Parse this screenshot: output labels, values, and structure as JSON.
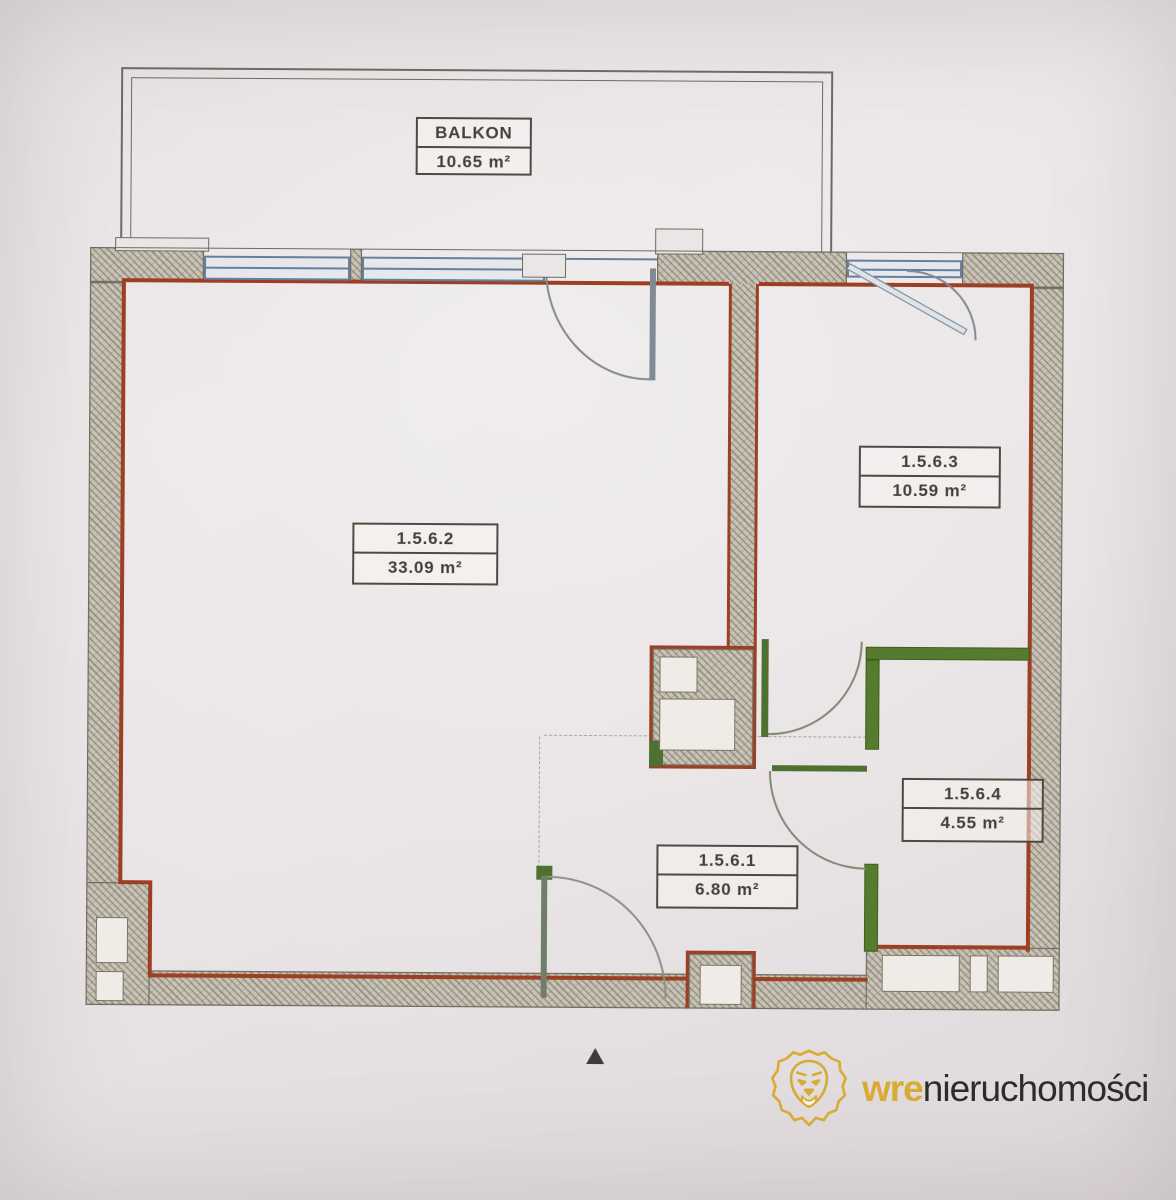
{
  "plan_title": "apartment-floor-plan",
  "balcony": {
    "name": "BALKON",
    "area": "10.65 m²"
  },
  "rooms": [
    {
      "id": "1.5.6.1",
      "area": "6.80 m²"
    },
    {
      "id": "1.5.6.2",
      "area": "33.09 m²"
    },
    {
      "id": "1.5.6.3",
      "area": "10.59 m²"
    },
    {
      "id": "1.5.6.4",
      "area": "4.55 m²"
    }
  ],
  "compass": {
    "glyph": "▲"
  },
  "logo": {
    "brand_gold": "wre",
    "brand_dark": "nieruchomości"
  },
  "colors": {
    "interior_wall_line": "#9c3f23",
    "partition_green": "#567a2e",
    "window_blue": "#66809c",
    "wall_fill": "#c9c3b6",
    "logo_gold": "#d8ab37",
    "logo_text": "#2e2c29",
    "paper": "#e8e3e4"
  }
}
